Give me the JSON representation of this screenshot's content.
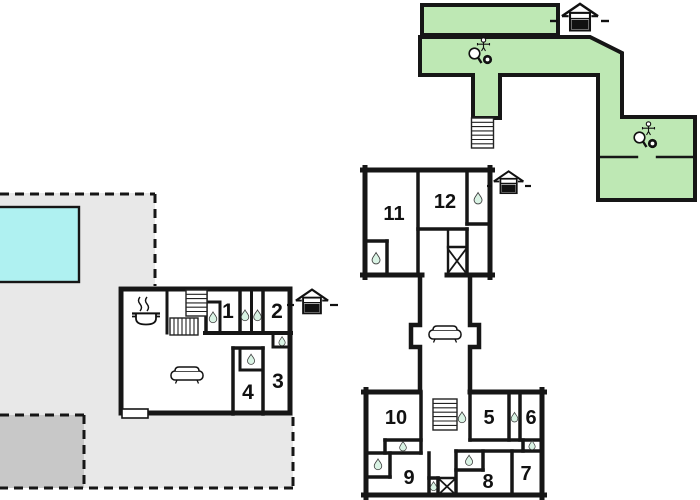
{
  "plan": {
    "type": "holiday-home-floor-plan",
    "rooms": {
      "r1": "1",
      "r2": "2",
      "r3": "3",
      "r4": "4",
      "r5": "5",
      "r6": "6",
      "r7": "7",
      "r8": "8",
      "r9": "9",
      "r10": "10",
      "r11": "11",
      "r12": "12"
    },
    "icons": {
      "entrance": "house-entrance",
      "bathroom": "water-drop",
      "kitchen": "cooking-pot",
      "lounge": "sofa",
      "stairs": "stairs",
      "shaft": "crossed-box",
      "recreation": "table-tennis",
      "pool": "swimming-pool"
    },
    "colors": {
      "wall": "#161616",
      "green": "#bee8b4",
      "pool": "#aff1f1",
      "terrace": "#e8e8e8",
      "terrace_shadow": "#c8c8c8",
      "drop": "#d9f3e4"
    }
  }
}
